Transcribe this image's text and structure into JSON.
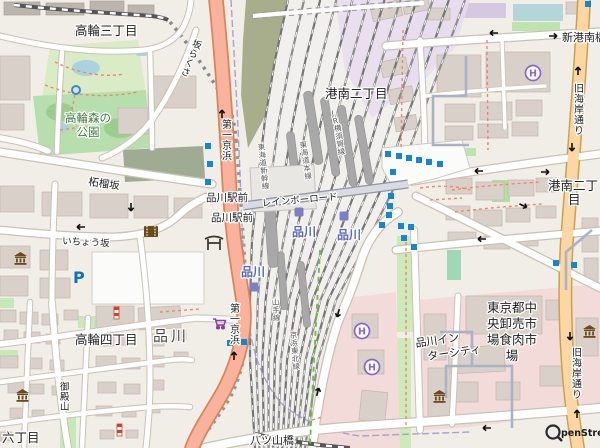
{
  "labels": {
    "takanawa3": "高輪三丁目",
    "park1": "高輪森の",
    "park2": "公園",
    "sakurazaka": "さくら坂",
    "konan2": "港南二丁目",
    "konan2r1": "港南二丁",
    "konan2r2": "目",
    "shinkonan": "新港南橋",
    "route15": "第一京浜",
    "kaigan": "旧海岸通り",
    "zakurozaka": "柘榴坂",
    "ichozaka": "いちょう坂",
    "ekimae": "品川駅前",
    "shinagawa": "品川",
    "big_shinagawa": "品川",
    "rainbow": "レインボーロード",
    "yatsuyama": "八ツ山橋",
    "takanawa4": "高輪四丁目",
    "rokuchome": "六丁目",
    "gotenyama": "御殿山",
    "intercity1": "品川イン",
    "intercity2": "ターシティ",
    "market1": "東京都中",
    "market2": "央卸売市",
    "market3": "場食肉市",
    "market4": "場",
    "jr_yokosuka": "JR横須賀線",
    "shinkansen": "東海道新幹線",
    "yamanote": "山手線",
    "keihintohoku": "京浜東北線",
    "tokaido": "東海道本線"
  },
  "icons": {
    "parking": "P",
    "hotel": "H"
  },
  "attribution": {
    "osm": "penStreetMap"
  },
  "colors": {
    "trunk_road": "#f9b29c",
    "primary_road": "#fcd6a4",
    "park_green": "#b7dfae",
    "market_pink": "#f3dbd9",
    "rail_gray": "#7d7d7d",
    "station_blue": "#5868c0",
    "bus_stop_blue": "#1586d2",
    "water_blue": "#aad3df",
    "boundary_purple": "#9a8fd0",
    "poi_brown": "#6d4a1c",
    "hotel_purple": "#8a63d2",
    "supermarket_purple": "#8a3fa8",
    "parking_blue": "#0d6ecd",
    "footpath_red": "#f4846e",
    "cycleway_green": "#6abf40"
  },
  "geometry": {
    "track_rows": [
      [
        0,
        288,
        465
      ],
      [
        60,
        275,
        443
      ],
      [
        120,
        265,
        420
      ],
      [
        180,
        258,
        398
      ],
      [
        240,
        252,
        368
      ],
      [
        300,
        250,
        336
      ],
      [
        360,
        250,
        318
      ],
      [
        448,
        255,
        305
      ]
    ],
    "track_count": 12,
    "bus_stops": [
      [
        208,
        146
      ],
      [
        210,
        164
      ],
      [
        208,
        182
      ],
      [
        230,
        343
      ],
      [
        244,
        342
      ],
      [
        388,
        154
      ],
      [
        399,
        156
      ],
      [
        409,
        158
      ],
      [
        419,
        160
      ],
      [
        429,
        162
      ],
      [
        440,
        164
      ],
      [
        393,
        172
      ],
      [
        391,
        196
      ],
      [
        390,
        206
      ],
      [
        389,
        215
      ],
      [
        382,
        225
      ],
      [
        401,
        226
      ],
      [
        411,
        227
      ],
      [
        404,
        238
      ],
      [
        414,
        247
      ],
      [
        556,
        263
      ],
      [
        574,
        265
      ],
      [
        588,
        4
      ]
    ],
    "station_markers": [
      [
        299,
        212
      ],
      [
        344,
        216
      ],
      [
        254,
        287
      ]
    ],
    "arrows": [
      [
        493,
        33,
        180
      ],
      [
        554,
        36,
        0
      ],
      [
        478,
        171,
        180
      ],
      [
        546,
        172,
        0
      ],
      [
        524,
        206,
        25
      ],
      [
        481,
        239,
        180
      ],
      [
        338,
        314,
        105
      ],
      [
        318,
        391,
        -75
      ],
      [
        486,
        428,
        180
      ],
      [
        578,
        70,
        -90
      ],
      [
        572,
        148,
        90
      ],
      [
        570,
        337,
        90
      ],
      [
        577,
        413,
        -90
      ],
      [
        222,
        113,
        -90
      ],
      [
        234,
        355,
        -90
      ],
      [
        131,
        208,
        90
      ],
      [
        80,
        227,
        180
      ]
    ],
    "buildings": [
      [
        4,
        2,
        36,
        13,
        0,
        1
      ],
      [
        46,
        3,
        38,
        12,
        0,
        1
      ],
      [
        90,
        1,
        34,
        13,
        0,
        1
      ],
      [
        128,
        5,
        26,
        11,
        0,
        1
      ],
      [
        0,
        56,
        30,
        44,
        0,
        0
      ],
      [
        0,
        104,
        24,
        26,
        0,
        0
      ],
      [
        148,
        76,
        48,
        32,
        0,
        0
      ],
      [
        118,
        108,
        30,
        26,
        0,
        0
      ],
      [
        0,
        186,
        34,
        26,
        0,
        0
      ],
      [
        42,
        192,
        40,
        24,
        0,
        0
      ],
      [
        90,
        194,
        38,
        24,
        0,
        0
      ],
      [
        134,
        196,
        34,
        22,
        0,
        0
      ],
      [
        174,
        198,
        28,
        20,
        0,
        0
      ],
      [
        0,
        246,
        30,
        22,
        0,
        0
      ],
      [
        40,
        250,
        28,
        20,
        0,
        0
      ],
      [
        0,
        276,
        28,
        20,
        0,
        0
      ],
      [
        40,
        278,
        30,
        20,
        0,
        0
      ],
      [
        96,
        306,
        38,
        24,
        0,
        0
      ],
      [
        138,
        308,
        42,
        22,
        -3,
        0
      ],
      [
        0,
        310,
        16,
        12,
        0,
        0
      ],
      [
        20,
        312,
        18,
        12,
        0,
        0
      ],
      [
        42,
        314,
        16,
        11,
        0,
        0
      ],
      [
        64,
        310,
        14,
        10,
        0,
        0
      ],
      [
        4,
        330,
        14,
        10,
        0,
        0
      ],
      [
        24,
        332,
        16,
        11,
        0,
        0
      ],
      [
        46,
        334,
        14,
        10,
        0,
        0
      ],
      [
        96,
        334,
        18,
        12,
        0,
        0
      ],
      [
        120,
        334,
        16,
        11,
        0,
        0
      ],
      [
        146,
        334,
        18,
        12,
        0,
        0
      ],
      [
        172,
        330,
        14,
        10,
        0,
        0
      ],
      [
        0,
        356,
        18,
        12,
        0,
        0
      ],
      [
        26,
        358,
        16,
        11,
        0,
        0
      ],
      [
        50,
        360,
        14,
        10,
        0,
        0
      ],
      [
        96,
        356,
        20,
        12,
        0,
        0
      ],
      [
        122,
        358,
        18,
        11,
        0,
        0
      ],
      [
        148,
        356,
        16,
        11,
        0,
        0
      ],
      [
        174,
        352,
        14,
        10,
        0,
        0
      ],
      [
        8,
        382,
        16,
        11,
        0,
        0
      ],
      [
        30,
        384,
        14,
        10,
        0,
        0
      ],
      [
        52,
        386,
        12,
        9,
        0,
        0
      ],
      [
        98,
        382,
        18,
        11,
        0,
        0
      ],
      [
        124,
        384,
        16,
        10,
        0,
        0
      ],
      [
        150,
        380,
        14,
        10,
        0,
        0
      ],
      [
        10,
        408,
        14,
        10,
        0,
        0
      ],
      [
        32,
        410,
        12,
        9,
        0,
        0
      ],
      [
        96,
        406,
        16,
        10,
        0,
        0
      ],
      [
        122,
        408,
        14,
        9,
        0,
        0
      ],
      [
        148,
        404,
        12,
        9,
        0,
        0
      ],
      [
        0,
        432,
        12,
        9,
        0,
        0
      ],
      [
        20,
        434,
        12,
        8,
        0,
        0
      ],
      [
        100,
        430,
        14,
        9,
        0,
        0
      ],
      [
        126,
        430,
        12,
        8,
        0,
        0
      ],
      [
        437,
        55,
        44,
        42,
        0,
        0
      ],
      [
        486,
        52,
        64,
        40,
        0,
        0
      ],
      [
        445,
        104,
        30,
        18,
        0,
        0
      ],
      [
        480,
        102,
        32,
        18,
        0,
        0
      ],
      [
        516,
        100,
        26,
        16,
        0,
        0
      ],
      [
        445,
        126,
        28,
        14,
        0,
        0
      ],
      [
        478,
        124,
        30,
        14,
        0,
        0
      ],
      [
        512,
        122,
        26,
        14,
        0,
        0
      ],
      [
        370,
        6,
        30,
        16,
        -12,
        0
      ],
      [
        402,
        2,
        26,
        13,
        -12,
        0
      ],
      [
        428,
        8,
        22,
        12,
        0,
        0
      ],
      [
        566,
        2,
        24,
        12,
        0,
        0
      ],
      [
        446,
        178,
        26,
        16,
        0,
        0
      ],
      [
        476,
        182,
        28,
        18,
        0,
        0
      ],
      [
        508,
        180,
        26,
        16,
        0,
        0
      ],
      [
        536,
        178,
        22,
        14,
        0,
        0
      ],
      [
        446,
        206,
        24,
        14,
        0,
        0
      ],
      [
        474,
        210,
        28,
        16,
        0,
        0
      ],
      [
        506,
        208,
        24,
        14,
        0,
        0
      ],
      [
        536,
        206,
        20,
        12,
        0,
        0
      ],
      [
        448,
        232,
        28,
        14,
        0,
        0
      ],
      [
        484,
        236,
        26,
        13,
        0,
        0
      ],
      [
        516,
        234,
        22,
        12,
        0,
        0
      ],
      [
        582,
        218,
        16,
        34,
        0,
        0
      ],
      [
        584,
        258,
        14,
        24,
        0,
        0
      ],
      [
        466,
        296,
        76,
        38,
        0,
        0
      ],
      [
        546,
        300,
        20,
        20,
        0,
        0
      ],
      [
        448,
        348,
        56,
        26,
        -3,
        0
      ],
      [
        448,
        382,
        30,
        20,
        0,
        0
      ],
      [
        496,
        382,
        24,
        18,
        0,
        0
      ],
      [
        540,
        366,
        24,
        20,
        0,
        0
      ],
      [
        576,
        318,
        22,
        38,
        0,
        0
      ],
      [
        352,
        314,
        26,
        24,
        0,
        0
      ],
      [
        358,
        350,
        26,
        24,
        0,
        0
      ],
      [
        362,
        390,
        26,
        30,
        6,
        0
      ],
      [
        424,
        314,
        22,
        46,
        0,
        0
      ],
      [
        428,
        368,
        22,
        50,
        0,
        0
      ],
      [
        380,
        62,
        26,
        16,
        -11,
        0
      ],
      [
        388,
        90,
        24,
        15,
        -10,
        0
      ],
      [
        394,
        118,
        22,
        14,
        -9,
        0
      ]
    ]
  }
}
